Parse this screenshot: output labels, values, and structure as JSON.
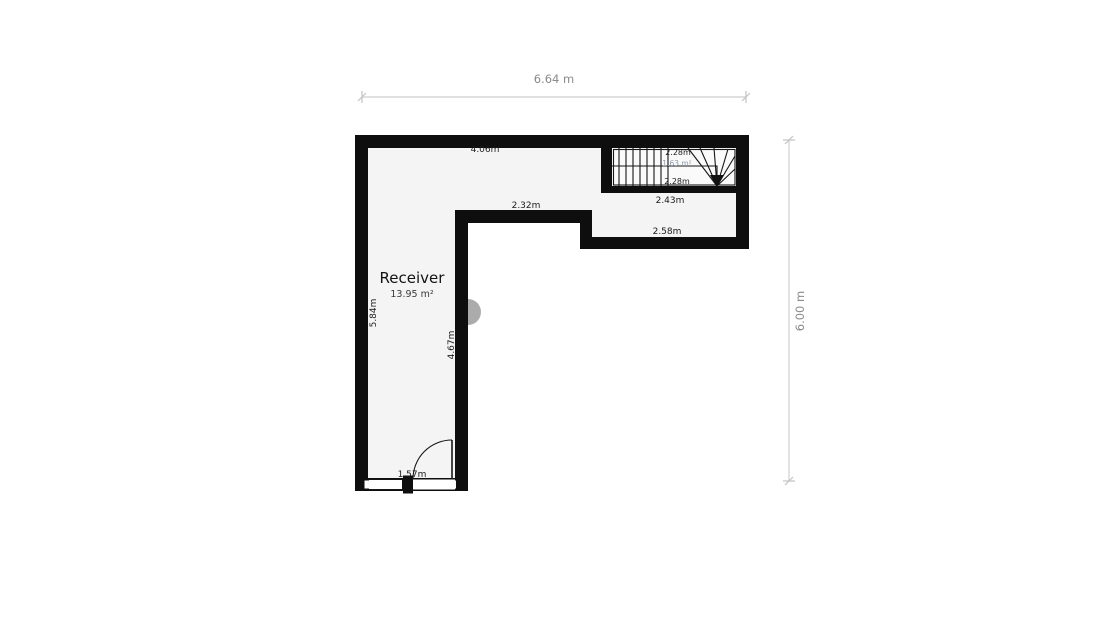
{
  "room": {
    "name": "Receiver",
    "area": "13.95 m²"
  },
  "stairs": {
    "upper_flight_length": "2.28m",
    "stair_area": "1.63 m²",
    "lower_flight_length": "2.28m",
    "width": "2.43m"
  },
  "measurements": {
    "top_wall_interior": "4.06m",
    "inner_wall_horizontal": "2.32m",
    "wing_interior_width": "2.58m",
    "left_wall_interior": "5.84m",
    "inner_wall_vertical": "4.67m",
    "entrance_width": "1.57m"
  },
  "overall": {
    "width": "6.64 m",
    "height": "6.00 m"
  },
  "colors": {
    "wall": "#0e0e0e",
    "floor": "#f4f4f4",
    "stair_floor": "#fafafa",
    "dim_line": "#d6d6d6",
    "dim_text": "#8a8a8a",
    "label_text": "#1b1b1b",
    "stair_area_text": "#8d99ae",
    "watermark": "#ababab"
  }
}
